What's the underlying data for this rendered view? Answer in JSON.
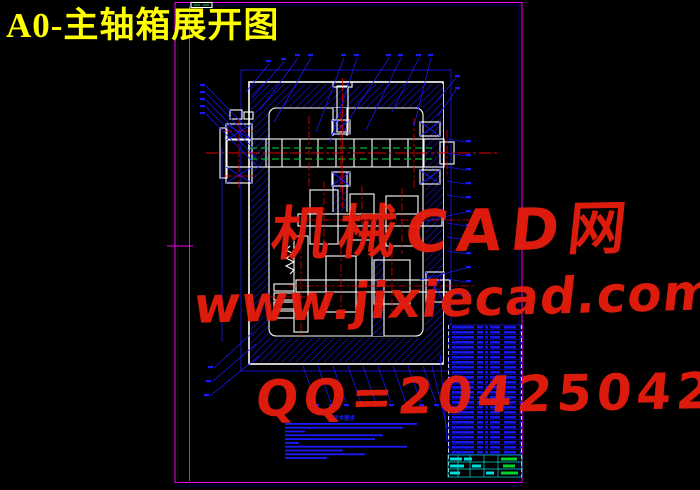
{
  "title": {
    "text": "A0-主轴箱展开图"
  },
  "watermark": {
    "line1": "机械CAD网",
    "line2": "www.jixiecad.com",
    "line3": "QQ=20425042"
  },
  "notes": {
    "heading": "技术要求",
    "line_count": 10
  },
  "bom": {
    "row_count": 26
  },
  "title_block": {
    "row_count": 3
  },
  "sheet": {
    "format": "A0"
  },
  "colors": {
    "background": "#000000",
    "cad_blue": "#1a1aff",
    "cad_blue_dim": "#0000cc",
    "line_white": "#ffffff",
    "centerline_red": "#e00000",
    "phantom_green": "#00b52a",
    "frame_magenta": "#f000f0",
    "table_cyan": "#00dcdc",
    "text_green": "#00d42c",
    "title_yellow": "#ffff00",
    "watermark_red": "#e51d0e"
  }
}
